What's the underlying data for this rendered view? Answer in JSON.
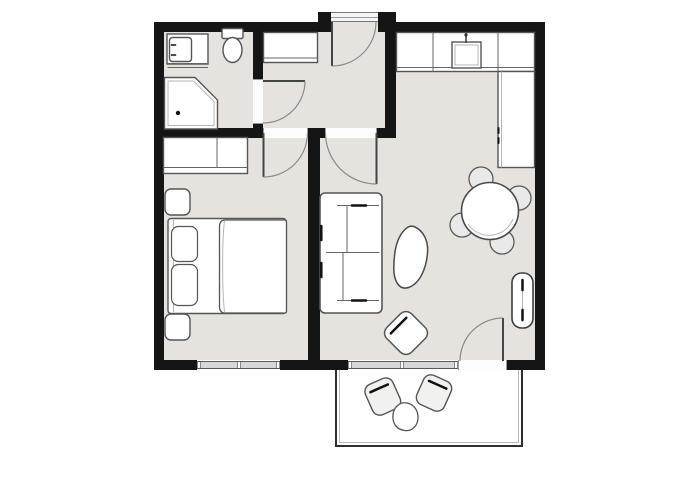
{
  "palette": {
    "background": "#ffffff",
    "wall": "#151515",
    "floor": "#e6e3de",
    "furniture_fill": "#ffffff",
    "furniture_stroke": "#555555",
    "accent_dark": "#111111",
    "window_band": "#d7d7d7",
    "door_arc": "#8a8a8a",
    "balcony_floor": "#ffffff",
    "chair_fill": "#e9e9e9"
  },
  "plan": {
    "type": "apartment-floor-plan",
    "rooms": [
      {
        "name": "bathroom",
        "furniture": [
          "vanity-sink",
          "toilet",
          "corner-shower"
        ]
      },
      {
        "name": "entry-hall",
        "furniture": [
          "entry-cabinet"
        ]
      },
      {
        "name": "kitchen",
        "furniture": [
          "kitchen-counter",
          "kitchen-sink",
          "tall-cabinet"
        ]
      },
      {
        "name": "bedroom",
        "furniture": [
          "wardrobe",
          "double-bed",
          "pillow",
          "pillow",
          "duvet",
          "nightstand",
          "nightstand"
        ]
      },
      {
        "name": "living-room",
        "furniture": [
          "sofa",
          "coffee-table",
          "armchair",
          "dining-table",
          "dining-chairs",
          "radiator"
        ]
      },
      {
        "name": "balcony",
        "furniture": [
          "outdoor-chair",
          "outdoor-chair",
          "side-table"
        ]
      }
    ],
    "openings": {
      "entrance_door": 1,
      "interior_doors": 3,
      "balcony_door": 1,
      "windows": 2
    }
  }
}
